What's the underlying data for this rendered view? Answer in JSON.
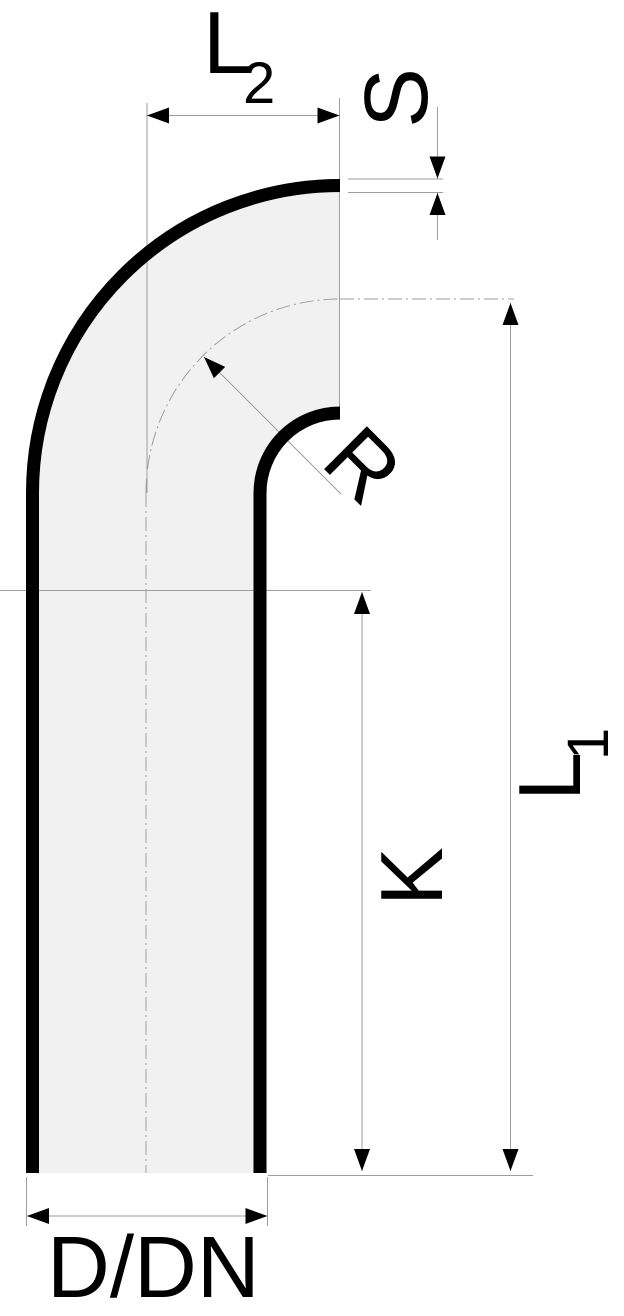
{
  "diagram": {
    "kind": "pipe-bend-90-degree-section-drawing",
    "labels": {
      "l2": {
        "main": "L",
        "sub": "2"
      },
      "s": "S",
      "r": "R",
      "l1": {
        "main": "L",
        "sub": "1"
      },
      "k": "K",
      "ddn": "D/DN"
    },
    "colors": {
      "outline": "#000000",
      "dimension_line": "#9e9e9e",
      "pipe_fill": "#f1f1f1",
      "background": "#ffffff"
    }
  }
}
